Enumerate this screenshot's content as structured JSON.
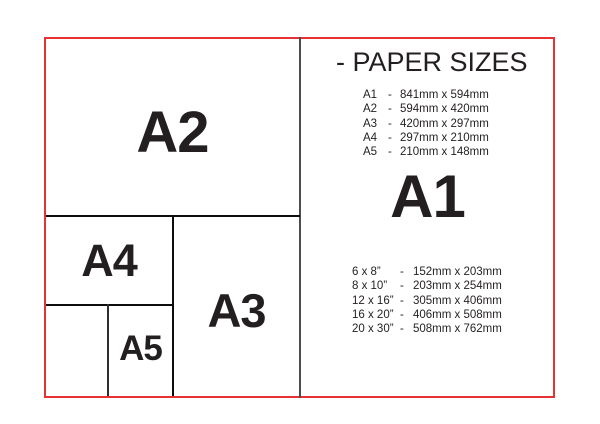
{
  "colors": {
    "frame_red": "#e83135",
    "inner_line_black": "#0d0d0d",
    "divider_gray": "#4d4d4d",
    "text": "#231f20"
  },
  "diagram": {
    "boxes": [
      {
        "id": "a2",
        "label": "A2"
      },
      {
        "id": "a4",
        "label": "A4"
      },
      {
        "id": "a3",
        "label": "A3"
      },
      {
        "id": "a5",
        "label": "A5"
      },
      {
        "id": "a6",
        "label": ""
      }
    ]
  },
  "panel": {
    "title": "- PAPER SIZES",
    "featured_size": "A1",
    "a_series": [
      {
        "label": "A1",
        "sep": "-",
        "value": "841mm x 594mm"
      },
      {
        "label": "A2",
        "sep": "-",
        "value": "594mm x 420mm"
      },
      {
        "label": "A3",
        "sep": "-",
        "value": "420mm x 297mm"
      },
      {
        "label": "A4",
        "sep": "-",
        "value": "297mm x 210mm"
      },
      {
        "label": "A5",
        "sep": "-",
        "value": "210mm x 148mm"
      }
    ],
    "inch_series": [
      {
        "label": "6 x 8”",
        "sep": "-",
        "value": "152mm x 203mm"
      },
      {
        "label": "8 x 10”",
        "sep": "-",
        "value": "203mm x 254mm"
      },
      {
        "label": "12 x 16”",
        "sep": "-",
        "value": "305mm x 406mm"
      },
      {
        "label": "16 x 20”",
        "sep": "-",
        "value": "406mm x 508mm"
      },
      {
        "label": "20 x 30”",
        "sep": "-",
        "value": "508mm x 762mm"
      }
    ]
  }
}
